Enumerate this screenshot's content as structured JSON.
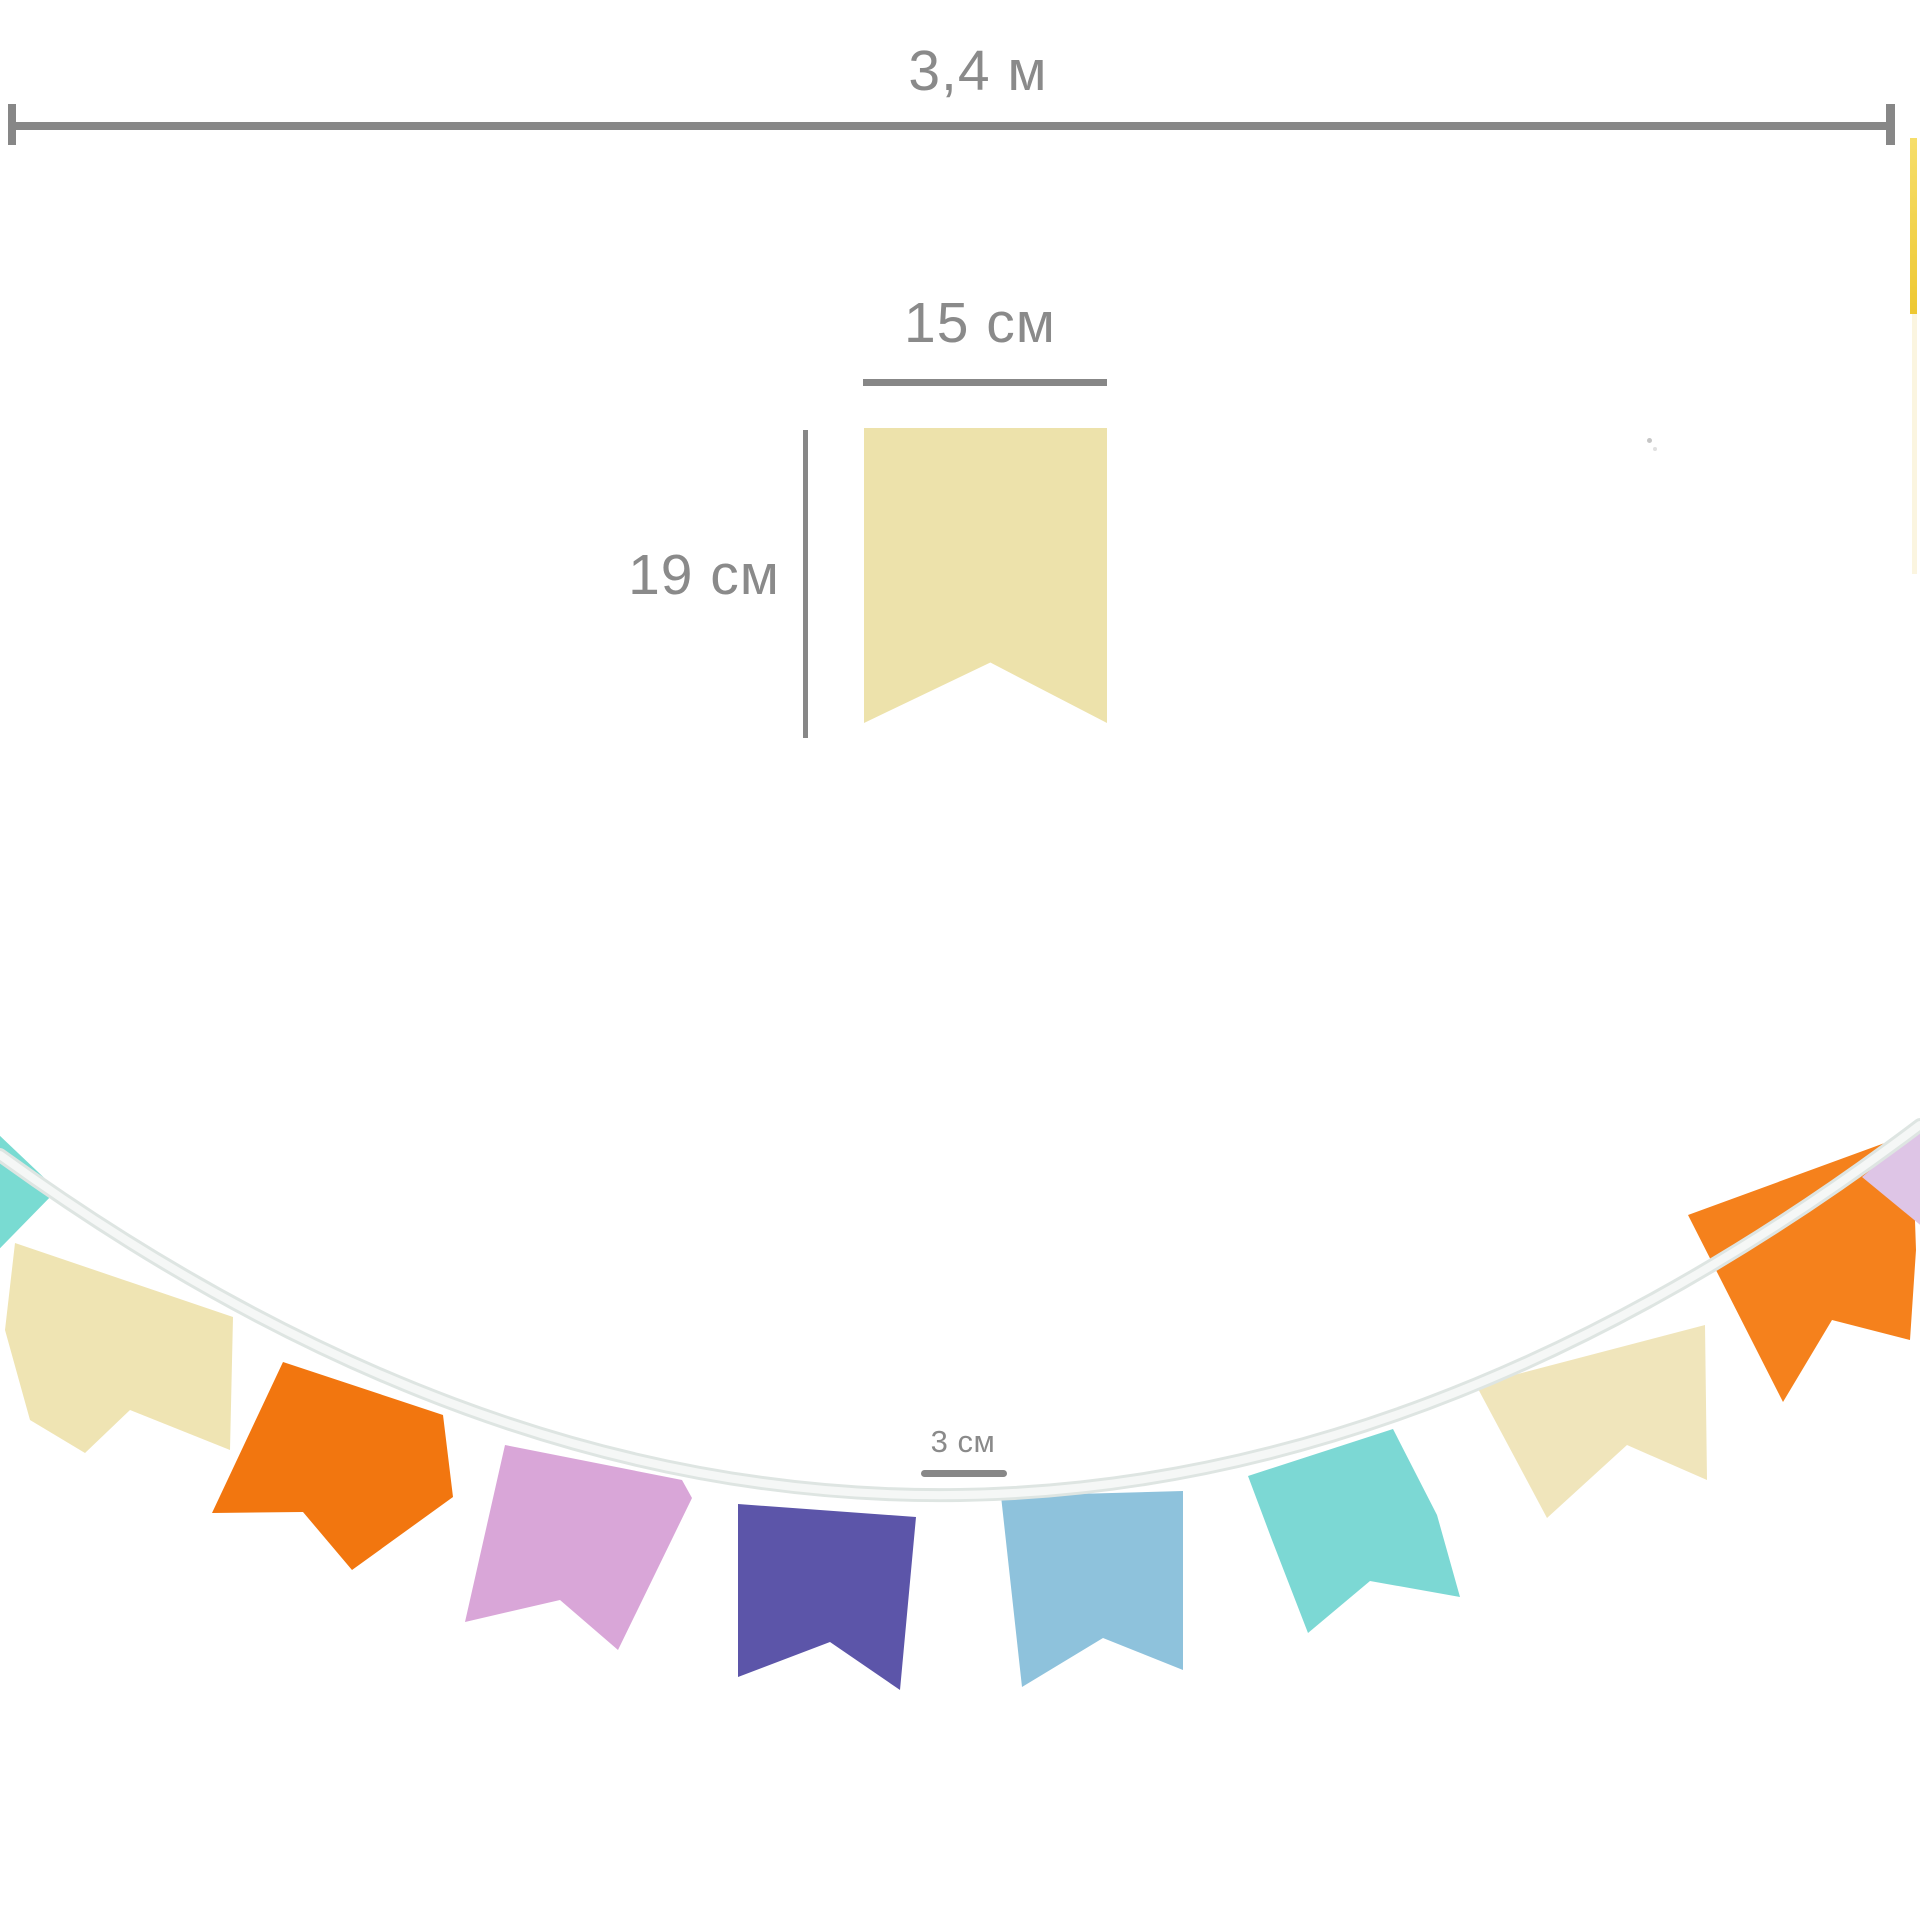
{
  "dimensions": {
    "total_length": {
      "label": "3,4 м"
    },
    "flag_width": {
      "label": "15 см"
    },
    "flag_height": {
      "label": "19 см"
    },
    "flag_gap": {
      "label": "3 см"
    }
  },
  "style": {
    "measure_color": "#878787",
    "text_color": "#8a8a8a",
    "background": "#ffffff"
  },
  "sample_flag": {
    "color": "#ede2ab",
    "shape": "swallowtail-pennant"
  },
  "garland": {
    "ribbon": {
      "path": "M 0 1155 Q 960 1850 1920 1125",
      "outer_color": "#dee5e2",
      "inner_color": "#f5f7f6"
    },
    "flags": [
      {
        "name": "teal-flag-left-edge",
        "color": "#79dbd2",
        "points": [
          [
            -80,
            1060
          ],
          [
            57,
            1190
          ],
          [
            -80,
            1330
          ]
        ]
      },
      {
        "name": "cream-flag-1",
        "color": "#efe4b3",
        "points": [
          [
            15,
            1243
          ],
          [
            233,
            1317
          ],
          [
            230,
            1450
          ],
          [
            130,
            1410
          ],
          [
            85,
            1453
          ],
          [
            30,
            1420
          ],
          [
            5,
            1330
          ]
        ]
      },
      {
        "name": "orange-flag-1",
        "color": "#f2760f",
        "points": [
          [
            283,
            1362
          ],
          [
            443,
            1415
          ],
          [
            453,
            1497
          ],
          [
            352,
            1570
          ],
          [
            303,
            1512
          ],
          [
            212,
            1513
          ]
        ]
      },
      {
        "name": "pink-lilac-flag",
        "color": "#d9a6d8",
        "points": [
          [
            505,
            1445
          ],
          [
            682,
            1480
          ],
          [
            692,
            1498
          ],
          [
            618,
            1650
          ],
          [
            560,
            1600
          ],
          [
            465,
            1622
          ]
        ]
      },
      {
        "name": "violet-flag",
        "color": "#5c55a9",
        "points": [
          [
            738,
            1504
          ],
          [
            916,
            1517
          ],
          [
            900,
            1690
          ],
          [
            830,
            1642
          ],
          [
            738,
            1677
          ]
        ]
      },
      {
        "name": "light-blue-flag",
        "color": "#8ec2dc",
        "points": [
          [
            1001,
            1496
          ],
          [
            1183,
            1491
          ],
          [
            1183,
            1670
          ],
          [
            1103,
            1638
          ],
          [
            1022,
            1687
          ]
        ]
      },
      {
        "name": "aqua-flag",
        "color": "#7cd8d4",
        "points": [
          [
            1248,
            1476
          ],
          [
            1393,
            1429
          ],
          [
            1437,
            1515
          ],
          [
            1460,
            1597
          ],
          [
            1370,
            1581
          ],
          [
            1308,
            1633
          ],
          [
            1272,
            1540
          ]
        ]
      },
      {
        "name": "cream-flag-2",
        "color": "#f0e5bb",
        "points": [
          [
            1476,
            1385
          ],
          [
            1705,
            1325
          ],
          [
            1707,
            1480
          ],
          [
            1627,
            1445
          ],
          [
            1547,
            1518
          ]
        ]
      },
      {
        "name": "orange-flag-2",
        "color": "#f5811c",
        "points": [
          [
            1688,
            1215
          ],
          [
            1912,
            1133
          ],
          [
            1916,
            1250
          ],
          [
            1910,
            1340
          ],
          [
            1832,
            1320
          ],
          [
            1783,
            1402
          ]
        ]
      },
      {
        "name": "lilac-flag-right-edge",
        "color": "#dec5e6",
        "points": [
          [
            1862,
            1177
          ],
          [
            1975,
            1082
          ],
          [
            1975,
            1270
          ]
        ]
      }
    ]
  },
  "edge_fragment": {
    "top_color": "#f6de6b",
    "bottom_color": "#eec832",
    "faint_color": "#faf3d8"
  }
}
